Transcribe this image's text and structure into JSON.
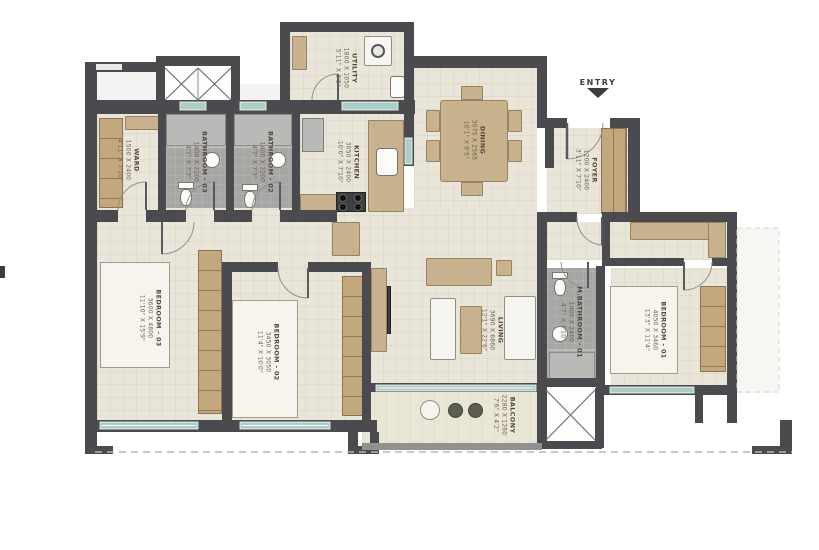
{
  "entry": {
    "label": "ENTRY"
  },
  "colors": {
    "wall": "#4b4b4f",
    "floor": "#e9e5d8",
    "bath_floor": "#a6a6a4",
    "window": "#a9cfc5",
    "furniture": "#c8b28d"
  },
  "rooms": {
    "utility": {
      "name": "UTILITY",
      "dim_mm": "1800 X 1050",
      "dim_ft": "5'11\" X 3'5\""
    },
    "ward": {
      "name": "WARD",
      "dim_mm": "1500 X 2400",
      "dim_ft": "4'11\" X 7'10\""
    },
    "bathroom_03": {
      "name": "BATHROOM - 03",
      "dim_mm": "1400 X 2200",
      "dim_ft": "4'7\" X 7'3\""
    },
    "bathroom_02": {
      "name": "BATHROOM - 02",
      "dim_mm": "1400 X 2200",
      "dim_ft": "4'7\" X 7'3\""
    },
    "kitchen": {
      "name": "KITCHEN",
      "dim_mm": "3050 X 2400",
      "dim_ft": "10'0\" X 7'10\""
    },
    "dining": {
      "name": "DINING",
      "dim_mm": "3075 X 2565",
      "dim_ft": "10'1\" X 8'5\""
    },
    "foyer": {
      "name": "FOYER",
      "dim_mm": "1200 X 2400",
      "dim_ft": "3'11\" X 7'10\""
    },
    "living": {
      "name": "LIVING",
      "dim_mm": "3690 X 6860",
      "dim_ft": "12'1\" X 22'6\""
    },
    "bedroom_03": {
      "name": "BEDROOM - 03",
      "dim_mm": "3600 X 4800",
      "dim_ft": "11'10\" X 15'9\""
    },
    "bedroom_02": {
      "name": "BEDROOM - 02",
      "dim_mm": "3450 X 3050",
      "dim_ft": "11'4\" X 10'0\""
    },
    "m_bathroom_01": {
      "name": "M.BATHROOM - 01",
      "dim_mm": "1400 X 2400",
      "dim_ft": "4'7\" X 7'10\""
    },
    "bedroom_01": {
      "name": "BEDROOM - 01",
      "dim_mm": "4050 X 3460",
      "dim_ft": "13'3\" X 11'4\""
    },
    "balcony": {
      "name": "BALCONY",
      "dim_mm": "2280 X 1260",
      "dim_ft": "7'6\" X 4'2\""
    }
  }
}
